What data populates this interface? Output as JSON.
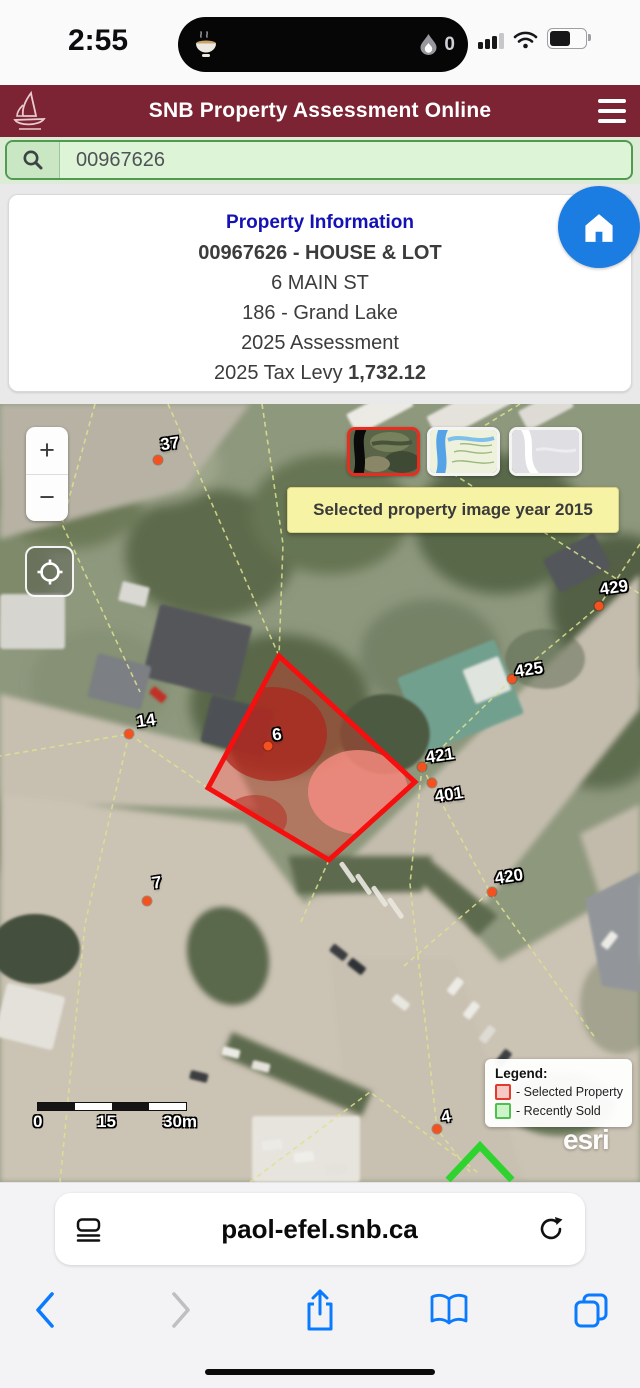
{
  "status_bar": {
    "time": "2:55",
    "island_count": "0",
    "battery_level_pct": 60
  },
  "header": {
    "title": "SNB Property Assessment Online",
    "bg_color": "#7C2433",
    "text_color": "#FFFFFF"
  },
  "search": {
    "value": "00967626"
  },
  "card": {
    "title": "Property Information",
    "id_line": "00967626 -  HOUSE & LOT",
    "address": "6 MAIN ST",
    "region": "186 - Grand Lake",
    "assessment": "2025 Assessment",
    "tax_levy_label": "2025 Tax Levy ",
    "tax_levy_value": "1,732.12",
    "title_color": "#1412B5",
    "home_button_color": "#1B7DE2"
  },
  "map": {
    "tooltip": "Selected property image year 2015",
    "zoom_in": "+",
    "zoom_out": "−",
    "basemaps": [
      {
        "name": "satellite",
        "selected": true
      },
      {
        "name": "topographic",
        "selected": false
      },
      {
        "name": "blank",
        "selected": false
      }
    ],
    "markers": [
      {
        "label": "37",
        "dot": [
          158,
          56
        ],
        "lab": [
          170,
          40
        ]
      },
      {
        "label": "429",
        "dot": [
          599,
          202
        ],
        "lab": [
          614,
          184
        ]
      },
      {
        "label": "425",
        "dot": [
          512,
          275
        ],
        "lab": [
          529,
          266
        ]
      },
      {
        "label": "14",
        "dot": [
          129,
          330
        ],
        "lab": [
          146,
          317
        ]
      },
      {
        "label": "6",
        "dot": [
          268,
          342
        ],
        "lab": [
          277,
          331
        ]
      },
      {
        "label": "421",
        "dot": [
          422,
          363
        ],
        "lab": [
          440,
          352
        ]
      },
      {
        "label": "401",
        "dot": [
          432,
          379
        ],
        "lab": [
          449,
          391
        ]
      },
      {
        "label": "420",
        "dot": [
          492,
          488
        ],
        "lab": [
          509,
          473
        ]
      },
      {
        "label": "7",
        "dot": [
          147,
          497
        ],
        "lab": [
          157,
          479
        ]
      },
      {
        "label": "4",
        "dot": [
          437,
          725
        ],
        "lab": [
          446,
          713
        ]
      }
    ],
    "marker_color": "#F4511E",
    "polygon_points": "279,252 415,378 329,456 208,384",
    "polygon_stroke": "#F50F0F",
    "sold_chevron_points": "448,776 480,742 512,776",
    "sold_chevron_color": "#2FD32F",
    "scale": {
      "labels": [
        "0",
        "15",
        "30m"
      ]
    },
    "legend": {
      "title": "Legend:",
      "items": [
        {
          "label": "- Selected Property",
          "border": "#E23B2E",
          "fill": "#F7C9C4"
        },
        {
          "label": "- Recently Sold",
          "border": "#4FC04F",
          "fill": "#CDF4C8"
        }
      ]
    },
    "attribution": "esri"
  },
  "browser": {
    "url": "paol-efel.snb.ca",
    "accent": "#0A7AFF"
  }
}
